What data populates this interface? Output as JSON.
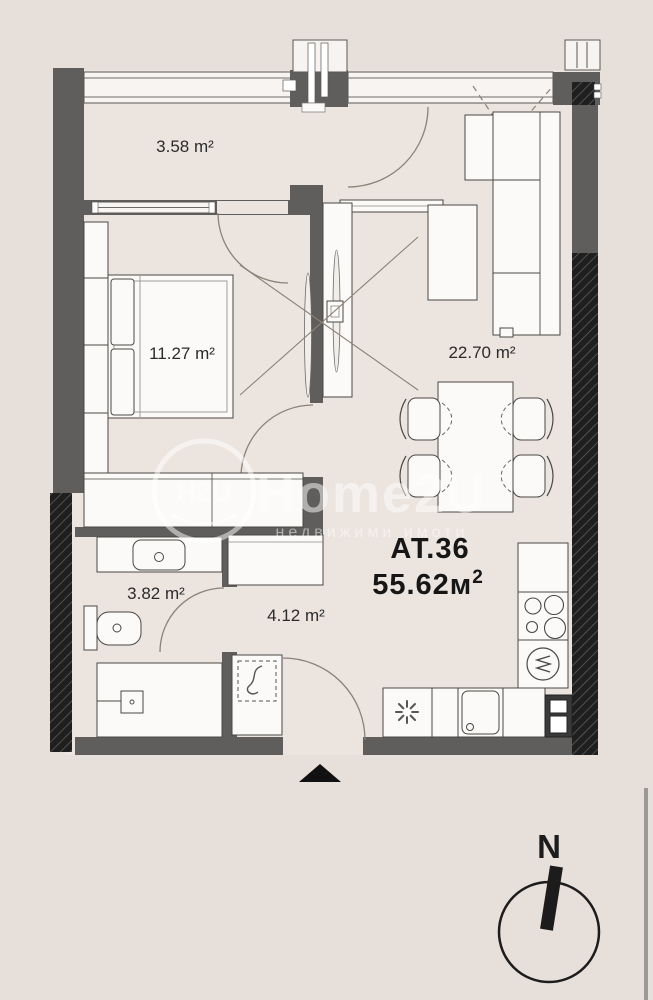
{
  "title": "Apartment floor plan",
  "rooms": {
    "balcony": {
      "name": "balcony",
      "area": "3.58 m²"
    },
    "bedroom": {
      "name": "bedroom",
      "area": "11.27 m²"
    },
    "living_room": {
      "name": "living-room",
      "area": "22.70 m²"
    },
    "bathroom": {
      "name": "bathroom",
      "area": "3.82 m²"
    },
    "hallway": {
      "name": "hallway",
      "area": "4.12 m²"
    }
  },
  "apartment": {
    "id": "АТ.36",
    "total_area_value": "55.62м",
    "total_area_sup": "2"
  },
  "compass": {
    "north": "N"
  },
  "watermark": {
    "logo_text": "H2U",
    "brand": "Home2U",
    "tagline": "недвижими имоти"
  },
  "icons": {
    "washing_machine": "✳",
    "entrance_marker": "▲",
    "water_heater": "S",
    "oven": "M"
  },
  "colors": {
    "background": "#e7dfda",
    "floor": "#ece4df",
    "wall": "#605e5c",
    "hatch_dark": "#1f1f1f",
    "furniture_fill": "#fbfaf8",
    "door_arc": "#8c8177",
    "label_text": "#2b2b2b",
    "accent_black": "#161616"
  }
}
